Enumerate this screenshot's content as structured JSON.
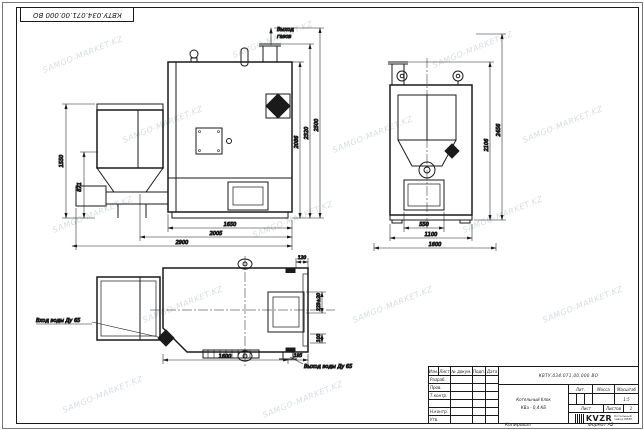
{
  "sheet": {
    "frame_number_top": "КВТУ.034.071.00.000 ВО",
    "watermark_text": "SAMGO-MARKET.KZ"
  },
  "front_view": {
    "gas_outlet_line1": "Выход",
    "gas_outlet_line2": "газов",
    "dim_left_outer": "1550",
    "dim_left_inner": "871",
    "dim_right_inner": "2086",
    "dim_right_mid": "2320",
    "dim_right_outer": "2500",
    "dim_bottom_inner": "1650",
    "dim_bottom_mid": "2005",
    "dim_bottom_outer": "2900"
  },
  "side_view": {
    "dim_right_inner": "2106",
    "dim_right_outer": "2456",
    "dim_bottom_inner": "550",
    "dim_bottom_mid": "1100",
    "dim_bottom_outer": "1600"
  },
  "plan_view": {
    "dim_top": "120",
    "dim_right_upper": "223±20",
    "dim_right_lower": "100",
    "dim_bottom_main": "1600",
    "dim_bottom_right": "195",
    "inlet_label": "Вход воды Ду 65",
    "outlet_label": "Выход воды Ду 65"
  },
  "title_block": {
    "doc_number": "КВТУ.034.071.00.000 ВО",
    "product_name_line1": "Котельный блок",
    "product_name_line2": "КВа - 0,4 КБ",
    "col_izm": "Изм.",
    "col_list": "Лист",
    "col_dokum": "№ докум.",
    "col_podp": "Подп.",
    "col_data": "Дата",
    "row_razrab": "Разраб.",
    "row_prov": "Пров.",
    "row_tkontr": "Т.контр.",
    "row_nkontr": "Н.контр.",
    "row_utv": "Утв.",
    "lit_header": "Лит.",
    "massa_header": "Масса",
    "masshtab_header": "Масштаб",
    "scale_value": "1:5",
    "list_label": "Лист",
    "listov_label": "Листов",
    "listov_value": "1",
    "logo_text": "KVZR",
    "logo_sub1": "Котельный",
    "logo_sub2": "завод КВЗР",
    "copied_label": "Копировал",
    "format_label": "Формат А2"
  }
}
